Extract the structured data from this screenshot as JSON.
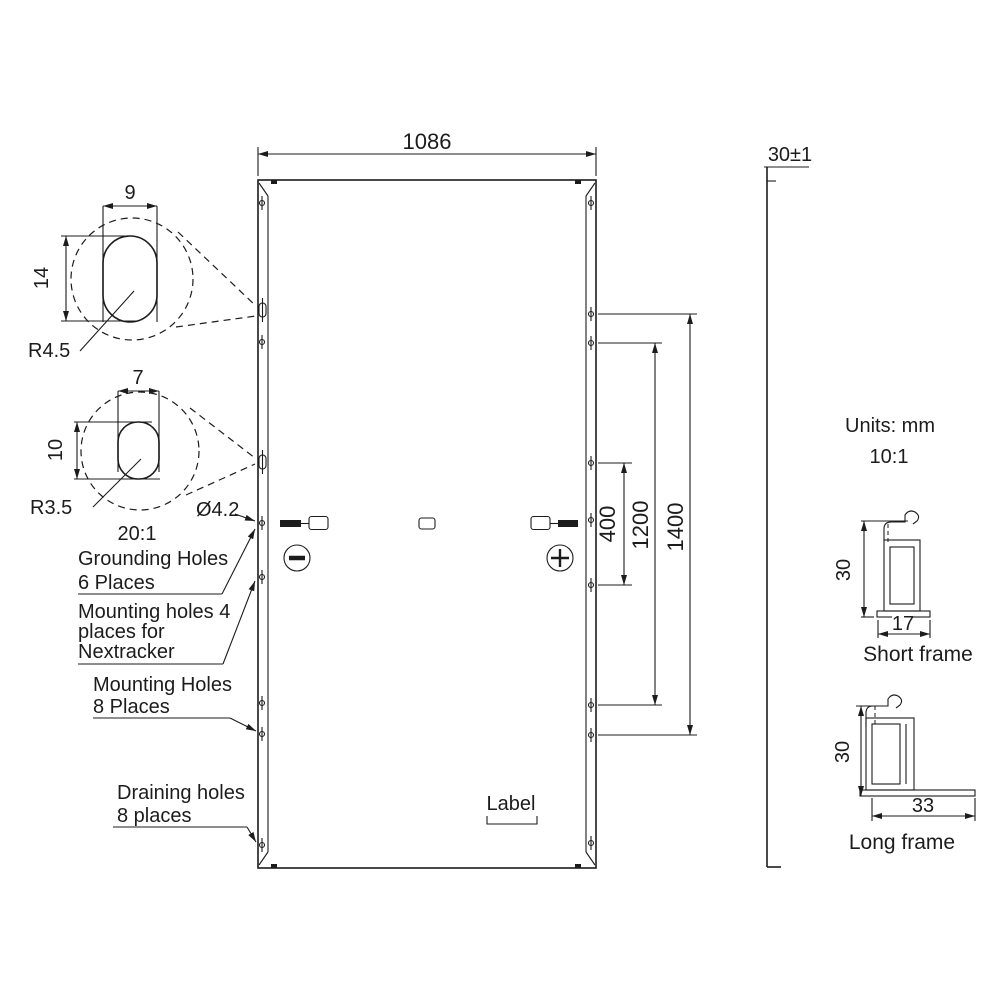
{
  "colors": {
    "line": "#1c1c1c",
    "background": "#ffffff"
  },
  "top_dimension": {
    "value": "1086"
  },
  "side_view": {
    "thickness": "30±1"
  },
  "detail_large_slot": {
    "width": "9",
    "height": "14",
    "radius": "R4.5"
  },
  "detail_small_slot": {
    "width": "7",
    "height": "10",
    "radius": "R3.5",
    "scale": "20:1"
  },
  "hole_diameter": "Ø4.2",
  "callouts": {
    "grounding": {
      "line1": "Grounding Holes",
      "line2": "6 Places"
    },
    "nextracker": {
      "line1": "Mounting holes 4",
      "line2": "places for",
      "line3": "Nextracker"
    },
    "mounting": {
      "line1": "Mounting Holes",
      "line2": "8 Places"
    },
    "draining": {
      "line1": "Draining holes",
      "line2": "8 places"
    }
  },
  "junction": {
    "negative_symbol": "minus",
    "positive_symbol": "plus"
  },
  "label_box": {
    "text": "Label"
  },
  "right_dimensions": {
    "inner": "400",
    "middle": "1200",
    "outer": "1400"
  },
  "notes": {
    "units": "Units: mm",
    "scale": "10:1"
  },
  "frames": {
    "short": {
      "caption": "Short frame",
      "height": "30",
      "width": "17"
    },
    "long": {
      "caption": "Long frame",
      "height": "30",
      "width": "33"
    }
  }
}
